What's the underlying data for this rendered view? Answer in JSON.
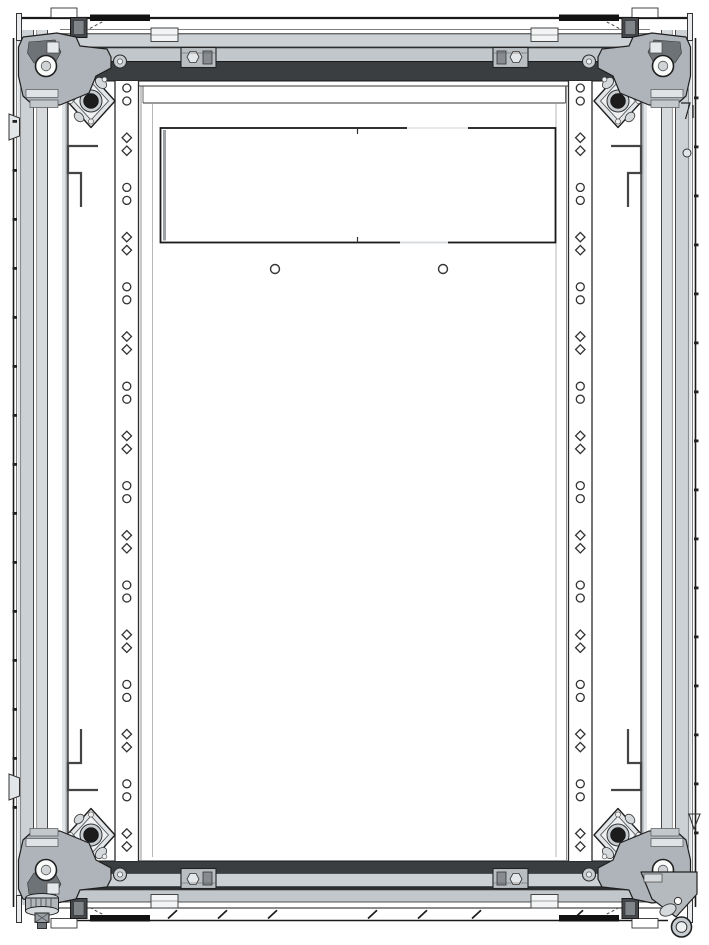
{
  "canvas": {
    "width": 709,
    "height": 945,
    "background": "#ffffff"
  },
  "colors": {
    "line": "#1a1a1a",
    "line_soft": "#555555",
    "charcoal_band": "#3a3e41",
    "seam_dark": "#2c2f31",
    "band_light": "#ccd1d5",
    "band_mid": "#c2c7cb",
    "band_lighter": "#dfe3e6",
    "black_bar": "#121212",
    "casting_gray": "#aeb4b9",
    "casting_dark": "#565b5f",
    "gusset_fill": "#e3e6e9",
    "gusset_inner": "#eef0f2",
    "gusset_ring": "#c8cdd1",
    "gusset_bolt": "#1c1c1c",
    "hole_stroke": "#333333",
    "panel_white": "#ffffff",
    "foot_gray": "#b2b7bc",
    "wheel_gray": "#c8cdd1"
  },
  "top_assembly": {
    "outer_line": {
      "y": 18,
      "x1": 21,
      "x2": 688
    },
    "seam_lines_y": [
      29.5,
      33.5
    ],
    "band1": {
      "x": 55,
      "y": 34,
      "w": 599,
      "h": 13
    },
    "band2": {
      "x": 55,
      "y": 47.5,
      "w": 599,
      "h": 14
    },
    "charcoal": {
      "x": 68,
      "y": 61.5,
      "w": 573,
      "h": 19.5
    }
  },
  "bottom_assembly": {
    "charcoal": {
      "x": 68,
      "y": 861,
      "w": 573,
      "h": 12.5
    },
    "band1": {
      "x": 55,
      "y": 873.5,
      "w": 599,
      "h": 13
    },
    "seam": {
      "x": 55,
      "y": 886.5,
      "w": 599,
      "h": 3.5
    },
    "band2": {
      "x": 55,
      "y": 890,
      "w": 599,
      "h": 12
    },
    "thin_line_y": 902,
    "sill_line1": {
      "y": 908,
      "x1": 55,
      "x2": 666
    },
    "sill_line2": {
      "y": 920.5,
      "x1": 55,
      "x2": 668
    },
    "tick_xs": [
      168,
      218,
      268,
      368,
      418,
      472,
      574,
      626
    ],
    "tick_len": 9
  },
  "rails": {
    "y_top": 81,
    "y_bottom": 861,
    "left": {
      "x1": 115,
      "x2": 138.5,
      "hole_cx": 126.8
    },
    "right": {
      "x1": 568.5,
      "x2": 592,
      "hole_cx": 580.3
    },
    "holes": {
      "groups": 16,
      "first_y": 88,
      "pitch": 49.7,
      "pair_gap": 13,
      "radius": 4,
      "alternating_shapes": [
        "circle",
        "diamond"
      ]
    }
  },
  "back_panel": {
    "top_line": {
      "y": 86,
      "x1": 138.5,
      "x2": 568.5
    },
    "inner_line": {
      "y": 103,
      "x1": 143,
      "x2": 565.5
    },
    "side_lines_x": [
      141,
      566.5,
      152.5,
      556
    ],
    "cutout": {
      "x": 160.5,
      "y": 128,
      "width": 395,
      "height": 114.5,
      "center_tick_x": 357.5
    },
    "mount_holes": [
      {
        "cx": 275,
        "cy": 269,
        "r": 4.5
      },
      {
        "cx": 443,
        "cy": 269,
        "r": 4.5
      }
    ]
  },
  "hooks": {
    "path": "M98,146 H68 V173 H81 V207"
  },
  "edge_nubs": {
    "pitch": 49,
    "w": 4.5,
    "h": 2.8,
    "left": {
      "x": 12.5,
      "first_y": 120,
      "count": 15
    },
    "right": {
      "x": 694,
      "first_y": 96.5,
      "count": 16
    }
  },
  "gussets": {
    "positions": [
      "top-left",
      "top-right",
      "bottom-left",
      "bottom-right"
    ],
    "black_circle_r": 7.5
  },
  "castings": {
    "positions": [
      "top-left",
      "top-right",
      "bottom-left",
      "bottom-right"
    ]
  }
}
